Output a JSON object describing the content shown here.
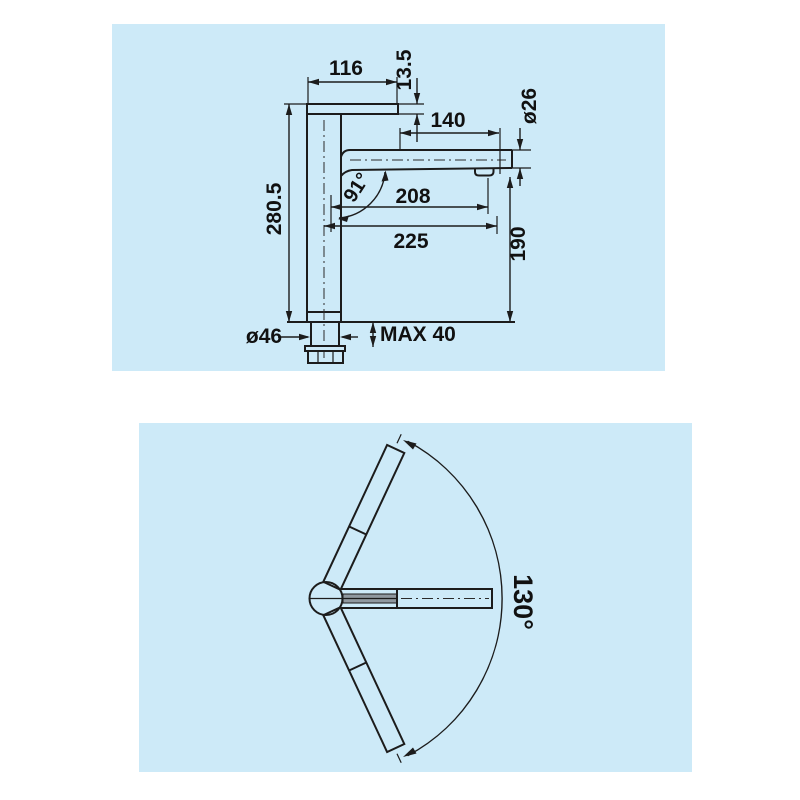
{
  "palette": {
    "page_bg": "#ffffff",
    "panel_bg": "#cdeaf8",
    "line_color": "#1c1c1c",
    "text_color": "#111111",
    "inner_hose_fill": "#8f989f"
  },
  "side_view_panel": {
    "description": "faucet side elevation with dimensions",
    "labels": {
      "lever_length": "116",
      "lever_thickness": "13.5",
      "spout_front_section": "140",
      "spout_diameter": "ø26",
      "height_above_deck": "280.5",
      "spout_angle": "91°",
      "reach_to_aerator": "208",
      "overall_reach": "225",
      "aerator_height": "190",
      "base_diameter": "ø46",
      "max_mounting_thickness": "MAX 40"
    }
  },
  "top_view_panel": {
    "description": "faucet plan view with swivel range",
    "labels": {
      "swivel_range": "130°"
    }
  }
}
